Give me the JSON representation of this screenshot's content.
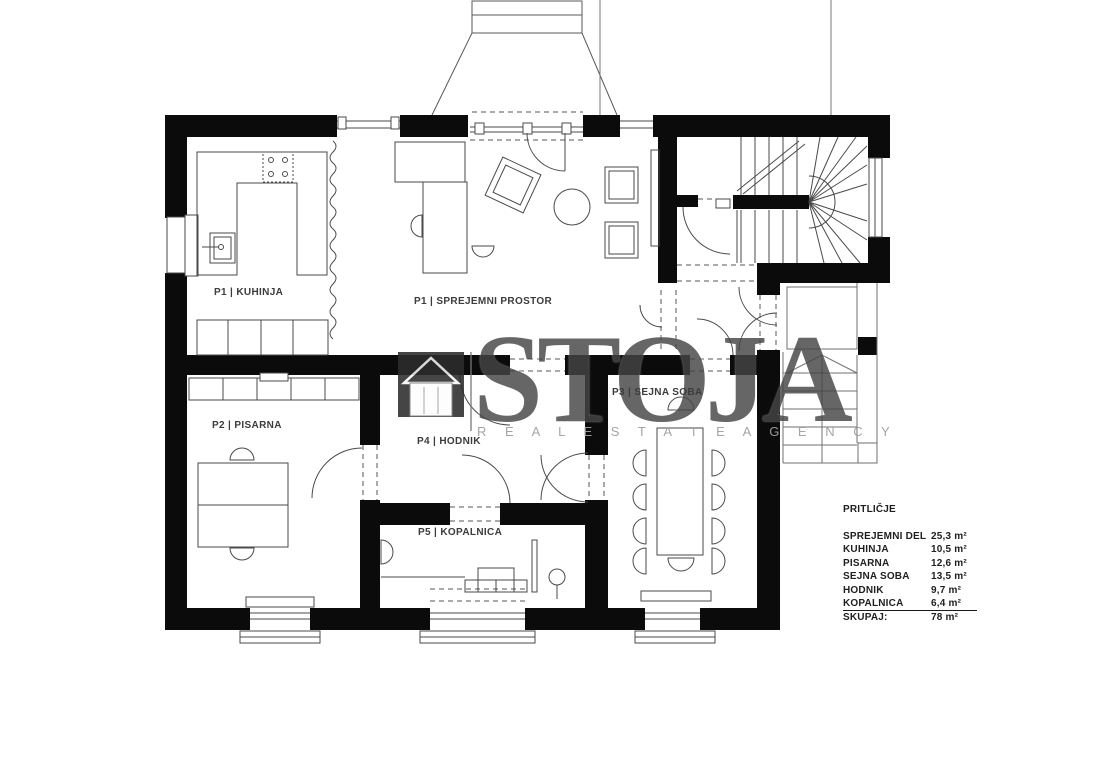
{
  "rooms": [
    {
      "label": "P1 | KUHINJA"
    },
    {
      "label": "P1 | SPREJEMNI PROSTOR"
    },
    {
      "label": "P2 | PISARNA"
    },
    {
      "label": "P3 | SEJNA SOBA"
    },
    {
      "label": "P4 | HODNIK"
    },
    {
      "label": "P5 | KOPALNICA"
    }
  ],
  "legend": {
    "title": "PRITLIČJE",
    "rows": [
      {
        "label": "SPREJEMNI DEL",
        "value": "25,3 m²"
      },
      {
        "label": "KUHINJA",
        "value": "10,5 m²"
      },
      {
        "label": "PISARNA",
        "value": "12,6 m²"
      },
      {
        "label": "SEJNA SOBA",
        "value": "13,5 m²"
      },
      {
        "label": "HODNIK",
        "value": "9,7 m²"
      },
      {
        "label": "KOPALNICA",
        "value": "6,4 m²"
      },
      {
        "label": "SKUPAJ:",
        "value": "78  m²"
      }
    ]
  },
  "watermark": {
    "brand": "STOJA",
    "tagline": "R E A L   E S T A T E   A G E N C Y",
    "icon": "house-icon"
  },
  "colors": {
    "wall": "#0b0b0b",
    "line": "#4a4a4a",
    "thin": "#6f6f6f",
    "watermark_gray": "#454545",
    "tagline_gray": "#a0a0a0"
  }
}
